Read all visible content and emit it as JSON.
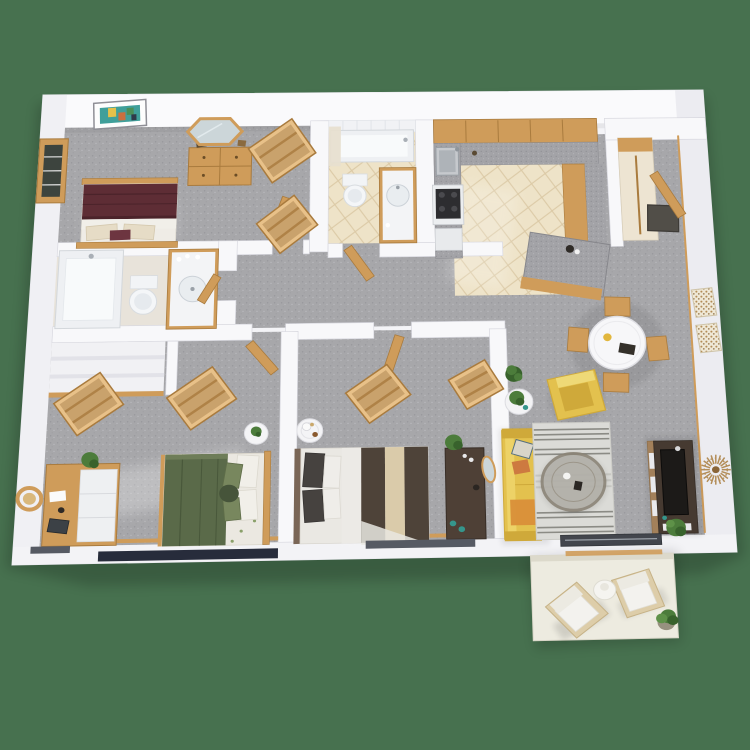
{
  "scene": {
    "type": "3d-floor-plan-render",
    "label": "3D floor plan of a two-bedroom, two-bathroom apartment with balcony",
    "background_color": "#47714f"
  },
  "palette": {
    "bg": "#47714f",
    "wallA": "#fafafc",
    "wallB": "#f4f4f7",
    "wallC": "#f0f0f4",
    "wallD": "#ececf1",
    "wallE": "#f3f3f6",
    "wallF": "#f8f8fa",
    "wallEdge": "#d9d9e0",
    "carpet": "#a7a7aa",
    "carpetDark": "#909094",
    "carpetLight": "#bcbcbf",
    "tile": "#eee3c8",
    "tileLine": "#dbc9a5",
    "bath": "#e8e3da",
    "counter": "#a3a3a7",
    "counterDark": "#85858a",
    "counterLight": "#bfbfc3",
    "wood": "#cf9c5a",
    "woodDark": "#a97b3e",
    "woodLight": "#e8c189",
    "maroon": "#5e2d35",
    "maroonDark": "#4b232a",
    "green": "#5a6a49",
    "greenDark": "#49583b",
    "greenLight": "#78875e",
    "sheet": "#eae8e3",
    "taupe": "#4e4339",
    "cream": "#dacbaa",
    "pillowDark": "#46423f",
    "yellow": "#e3c14e",
    "yellowDeep": "#cfa93a",
    "orange": "#d98f39",
    "rug": "#dbdbd7",
    "rugStripe": "#70706a",
    "console": "#463a31",
    "consoleWood": "#a3805a",
    "tvBlack": "#1c1a18",
    "gold": "#b38d58",
    "plantG": "#4c7c3b",
    "plantD": "#38622c",
    "balcony": "#edebe0",
    "balconyEdge": "#d9d6c8",
    "navy": "#272c3b",
    "track": "#43464d",
    "slit": "#565a63",
    "mat": "#514e48",
    "teal": "#35968c",
    "mirror": "#ccd6d9"
  },
  "rooms": [
    {
      "name": "master-bedroom",
      "furniture": [
        "double-bed-maroon",
        "wood-dresser",
        "hexagon-mirror",
        "framed-wall-art",
        "window",
        "open-wardrobe",
        "open-wardrobe"
      ]
    },
    {
      "name": "master-bathroom",
      "furniture": [
        "bathtub",
        "toilet",
        "vanity-sink"
      ]
    },
    {
      "name": "linen-closet",
      "furniture": [
        "shelves"
      ]
    },
    {
      "name": "hall-bathroom",
      "furniture": [
        "bathtub-shower",
        "shower-curtain",
        "toilet",
        "vanity-sink"
      ]
    },
    {
      "name": "kitchen",
      "furniture": [
        "upper-cabinets",
        "counter-with-sink",
        "range-stove",
        "dishwasher",
        "island-peninsula"
      ]
    },
    {
      "name": "entry",
      "furniture": [
        "front-door",
        "doormat",
        "coat-closet"
      ]
    },
    {
      "name": "dining-area",
      "furniture": [
        "round-dining-table",
        "dining-chair",
        "dining-chair",
        "dining-chair",
        "dining-chair",
        "mosaic-wall-art",
        "mosaic-wall-art"
      ]
    },
    {
      "name": "living-room",
      "furniture": [
        "yellow-sofa",
        "yellow-armchair",
        "round-side-table",
        "striped-area-rug",
        "round-coffee-table",
        "tv-console",
        "television",
        "sunburst-wall-decor",
        "potted-plant",
        "sliding-glass-door"
      ]
    },
    {
      "name": "hallway",
      "furniture": [
        "wood-doors"
      ]
    },
    {
      "name": "bedroom-2",
      "furniture": [
        "double-bed-green",
        "desk",
        "desk-chair",
        "potted-plant",
        "open-wardrobe",
        "open-wardrobe",
        "round-nightstand",
        "closet-shelves",
        "window"
      ]
    },
    {
      "name": "bedroom-3",
      "furniture": [
        "double-bed-striped",
        "dark-dresser",
        "round-mirror",
        "potted-plant",
        "open-wardrobe",
        "open-wardrobe",
        "round-nightstand-coffee-set",
        "window"
      ]
    },
    {
      "name": "balcony",
      "furniture": [
        "outdoor-armchair",
        "outdoor-armchair",
        "round-patio-table",
        "potted-plant"
      ]
    }
  ]
}
